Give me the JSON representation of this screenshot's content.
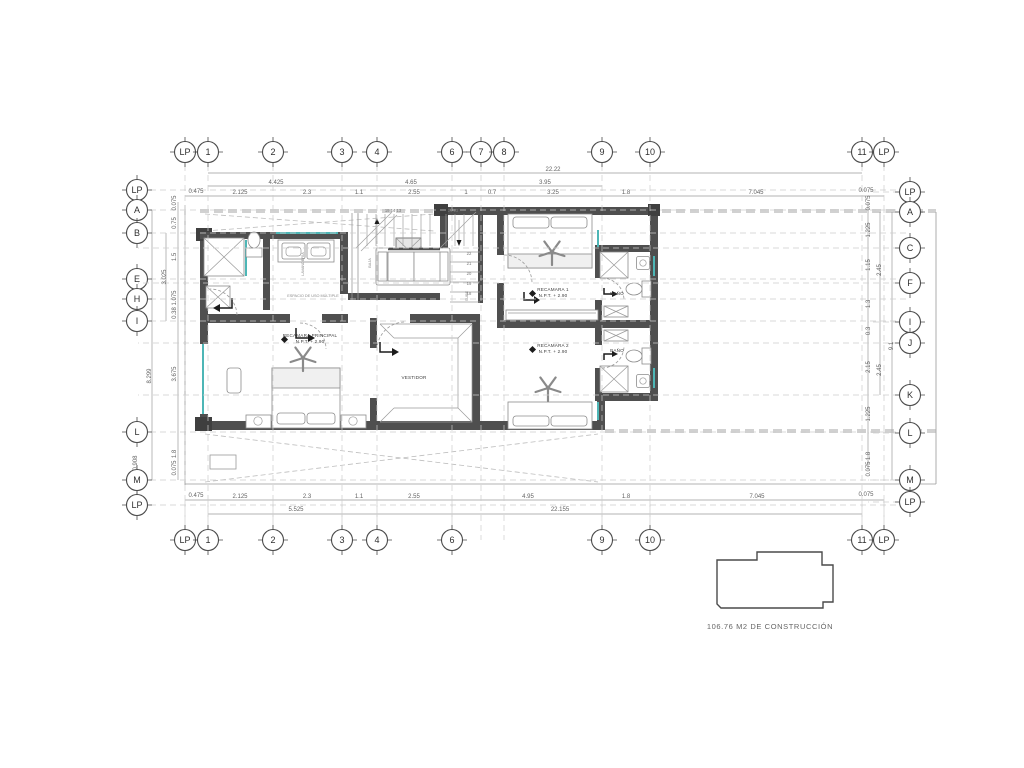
{
  "colors": {
    "wall": "#4f4f4f",
    "window_teal": "#4db6b6",
    "grid_dash": "#cccccc",
    "dim_line": "#9a9a9a",
    "text": "#5f5f5f"
  },
  "grid": {
    "top": [
      {
        "label": "LP",
        "x": 185,
        "y": 152
      },
      {
        "label": "1",
        "x": 208,
        "y": 152
      },
      {
        "label": "2",
        "x": 273,
        "y": 152
      },
      {
        "label": "3",
        "x": 342,
        "y": 152
      },
      {
        "label": "4",
        "x": 377,
        "y": 152
      },
      {
        "label": "6",
        "x": 452,
        "y": 152
      },
      {
        "label": "7",
        "x": 481,
        "y": 152
      },
      {
        "label": "8",
        "x": 504,
        "y": 152
      },
      {
        "label": "9",
        "x": 602,
        "y": 152
      },
      {
        "label": "10",
        "x": 650,
        "y": 152
      },
      {
        "label": "11",
        "x": 862,
        "y": 152
      },
      {
        "label": "LP",
        "x": 884,
        "y": 152
      }
    ],
    "bottom": [
      {
        "label": "LP",
        "x": 185,
        "y": 540
      },
      {
        "label": "1",
        "x": 208,
        "y": 540
      },
      {
        "label": "2",
        "x": 273,
        "y": 540
      },
      {
        "label": "3",
        "x": 342,
        "y": 540
      },
      {
        "label": "4",
        "x": 377,
        "y": 540
      },
      {
        "label": "6",
        "x": 452,
        "y": 540
      },
      {
        "label": "9",
        "x": 602,
        "y": 540
      },
      {
        "label": "10",
        "x": 650,
        "y": 540
      },
      {
        "label": "11",
        "x": 862,
        "y": 540
      },
      {
        "label": "LP",
        "x": 884,
        "y": 540
      }
    ],
    "left": [
      {
        "label": "LP",
        "x": 137,
        "y": 190
      },
      {
        "label": "A",
        "x": 137,
        "y": 210
      },
      {
        "label": "B",
        "x": 137,
        "y": 233
      },
      {
        "label": "E",
        "x": 137,
        "y": 279
      },
      {
        "label": "H",
        "x": 137,
        "y": 299
      },
      {
        "label": "I",
        "x": 137,
        "y": 321
      },
      {
        "label": "L",
        "x": 137,
        "y": 432
      },
      {
        "label": "M",
        "x": 137,
        "y": 480
      },
      {
        "label": "LP",
        "x": 137,
        "y": 505
      }
    ],
    "right": [
      {
        "label": "LP",
        "x": 910,
        "y": 192,
        "x2": -42
      },
      {
        "label": "A",
        "x": 910,
        "y": 212,
        "x2": -42
      },
      {
        "label": "C",
        "x": 910,
        "y": 248,
        "x2": -772
      },
      {
        "label": "F",
        "x": 910,
        "y": 283,
        "x2": -772
      },
      {
        "label": "I",
        "x": 910,
        "y": 322,
        "x2": -42
      },
      {
        "label": "J",
        "x": 910,
        "y": 343,
        "x2": -772
      },
      {
        "label": "K",
        "x": 910,
        "y": 395,
        "x2": -772
      },
      {
        "label": "L",
        "x": 910,
        "y": 433,
        "x2": -42
      },
      {
        "label": "M",
        "x": 910,
        "y": 480,
        "x2": -42
      },
      {
        "label": "LP",
        "x": 910,
        "y": 502,
        "x2": -42
      }
    ]
  },
  "dims": {
    "top": [
      {
        "t": "22.22",
        "x": 553,
        "y": 171
      },
      {
        "t": "4.425",
        "x": 276,
        "y": 184
      },
      {
        "t": "4.65",
        "x": 411,
        "y": 184
      },
      {
        "t": "3.95",
        "x": 545,
        "y": 184
      },
      {
        "t": "0.475",
        "x": 196,
        "y": 193
      },
      {
        "t": "2.125",
        "x": 240,
        "y": 194
      },
      {
        "t": "2.3",
        "x": 307,
        "y": 194
      },
      {
        "t": "1.1",
        "x": 359,
        "y": 194
      },
      {
        "t": "2.55",
        "x": 414,
        "y": 194
      },
      {
        "t": "1",
        "x": 466,
        "y": 194
      },
      {
        "t": "0.7",
        "x": 492,
        "y": 194
      },
      {
        "t": "3.25",
        "x": 553,
        "y": 194
      },
      {
        "t": "1.8",
        "x": 626,
        "y": 194
      },
      {
        "t": "7.045",
        "x": 756,
        "y": 194
      },
      {
        "t": "0.075",
        "x": 866,
        "y": 192
      }
    ],
    "bottom": [
      {
        "t": "0.475",
        "x": 196,
        "y": 497
      },
      {
        "t": "2.125",
        "x": 240,
        "y": 498
      },
      {
        "t": "2.3",
        "x": 307,
        "y": 498
      },
      {
        "t": "1.1",
        "x": 359,
        "y": 498
      },
      {
        "t": "2.55",
        "x": 414,
        "y": 498
      },
      {
        "t": "4.95",
        "x": 528,
        "y": 498
      },
      {
        "t": "1.8",
        "x": 626,
        "y": 498
      },
      {
        "t": "7.045",
        "x": 757,
        "y": 498
      },
      {
        "t": "0.075",
        "x": 866,
        "y": 496
      },
      {
        "t": "5.525",
        "x": 296,
        "y": 511
      },
      {
        "t": "22.155",
        "x": 560,
        "y": 511
      }
    ],
    "left": [
      {
        "t": "0.075",
        "x": 176,
        "y": 203
      },
      {
        "t": "0.75",
        "x": 176,
        "y": 223
      },
      {
        "t": "1.5",
        "x": 176,
        "y": 257
      },
      {
        "t": "3.025",
        "x": 166,
        "y": 277
      },
      {
        "t": "1.075",
        "x": 176,
        "y": 298
      },
      {
        "t": "0.38",
        "x": 176,
        "y": 313
      },
      {
        "t": "8.299",
        "x": 151,
        "y": 376
      },
      {
        "t": "3.675",
        "x": 176,
        "y": 374
      },
      {
        "t": "1.8",
        "x": 176,
        "y": 454
      },
      {
        "t": "0.075",
        "x": 176,
        "y": 468
      },
      {
        "t": "0.908",
        "x": 137,
        "y": 463
      }
    ],
    "right": [
      {
        "t": "0.075",
        "x": 870,
        "y": 203
      },
      {
        "t": "1.225",
        "x": 870,
        "y": 230
      },
      {
        "t": "1.15",
        "x": 870,
        "y": 265
      },
      {
        "t": "2.45",
        "x": 881,
        "y": 270
      },
      {
        "t": "1.3",
        "x": 870,
        "y": 304
      },
      {
        "t": "0.3",
        "x": 870,
        "y": 331
      },
      {
        "t": "9.1",
        "x": 893,
        "y": 346
      },
      {
        "t": "2.15",
        "x": 870,
        "y": 367
      },
      {
        "t": "2.45",
        "x": 881,
        "y": 370
      },
      {
        "t": "1.225",
        "x": 870,
        "y": 414
      },
      {
        "t": "1.8",
        "x": 870,
        "y": 456
      },
      {
        "t": "0.075",
        "x": 870,
        "y": 469
      }
    ]
  },
  "texts": {
    "rooms": [
      {
        "t": "RECAMARA PRINCIPAL",
        "x": 310,
        "y": 337
      },
      {
        "t": "N.P.T. + 2.90",
        "x": 310,
        "y": 343
      },
      {
        "t": "RECAMARA 1",
        "x": 553,
        "y": 291
      },
      {
        "t": "N.P.T. + 2.90",
        "x": 553,
        "y": 297
      },
      {
        "t": "RECAMARA 2",
        "x": 553,
        "y": 347
      },
      {
        "t": "N.P.T. + 2.90",
        "x": 553,
        "y": 353
      },
      {
        "t": "VESTIDOR",
        "x": 414,
        "y": 379
      },
      {
        "t": "BAÑO",
        "x": 617,
        "y": 295
      },
      {
        "t": "BAÑO",
        "x": 617,
        "y": 352
      }
    ],
    "tiny": [
      {
        "t": "ESPACIO DE USO MÚLTIPLE",
        "x": 313,
        "y": 297
      }
    ],
    "tiny_rot": [
      {
        "t": "LAVANDERÍA",
        "x": 304,
        "y": 264
      },
      {
        "t": "BAJA",
        "x": 371,
        "y": 263
      },
      {
        "t": "SUBE",
        "x": 468,
        "y": 296
      }
    ],
    "stair_numbers": [
      {
        "t": "19 14 13",
        "x": 393,
        "y": 212
      },
      {
        "t": "24 23",
        "x": 453,
        "y": 212
      },
      {
        "t": "22",
        "x": 469,
        "y": 255
      },
      {
        "t": "21",
        "x": 469,
        "y": 265
      },
      {
        "t": "20",
        "x": 469,
        "y": 275
      },
      {
        "t": "19",
        "x": 469,
        "y": 285
      },
      {
        "t": "18",
        "x": 469,
        "y": 295
      }
    ]
  },
  "keyplan": {
    "caption": "106.76 M2 DE CONSTRUCCIÓN"
  }
}
